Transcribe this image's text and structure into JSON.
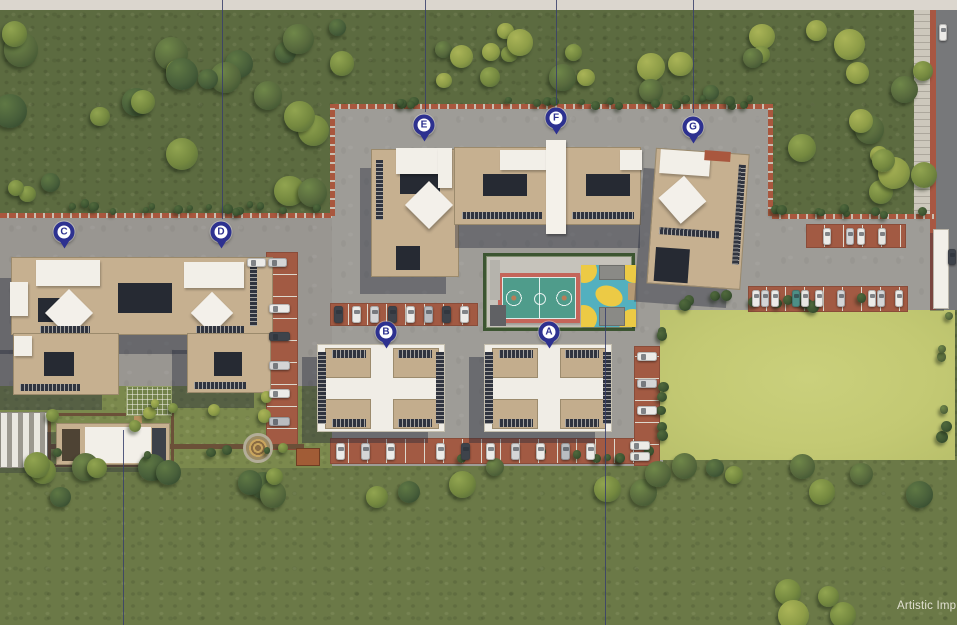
{
  "watermark": "Artistic Imp",
  "pin_color": "#2d3190",
  "pins": [
    {
      "label": "A",
      "x": 549,
      "y": 332
    },
    {
      "label": "B",
      "x": 386,
      "y": 332
    },
    {
      "label": "C",
      "x": 64,
      "y": 232
    },
    {
      "label": "D",
      "x": 221,
      "y": 232
    },
    {
      "label": "E",
      "x": 424,
      "y": 125
    },
    {
      "label": "F",
      "x": 556,
      "y": 118
    },
    {
      "label": "G",
      "x": 693,
      "y": 127
    }
  ],
  "leader_lines": [
    {
      "x": 222,
      "from": 0,
      "to": 219
    },
    {
      "x": 425,
      "from": 0,
      "to": 112
    },
    {
      "x": 556,
      "from": 0,
      "to": 104
    },
    {
      "x": 693,
      "from": 0,
      "to": 113
    },
    {
      "x": 123,
      "from": 430,
      "to": 625
    },
    {
      "x": 605,
      "from": 308,
      "to": 625
    }
  ],
  "features": [
    "basketball-court",
    "kids-play-area",
    "clubhouse",
    "open-lawn",
    "landscaped-garden",
    "surface-parking",
    "perimeter-trees",
    "access-road"
  ],
  "palette": {
    "grass_top": "#5c6b40",
    "grass_bottom": "#6b7947",
    "open_lawn": "#c3c973",
    "pavement": "#9e9c97",
    "road": "#77787a",
    "brick": "#a25a43",
    "building_tan": "#c6b090",
    "roof_white": "#f2efe8",
    "court_teal": "#4f9c8b",
    "court_frame": "#c4655a",
    "play_blue": "#53b0bf",
    "play_yellow": "#ecca45",
    "hedge": "#3c5531",
    "pin": "#2d3190",
    "leader_line": "#38406b",
    "watermark_text": "#ece9dd"
  }
}
